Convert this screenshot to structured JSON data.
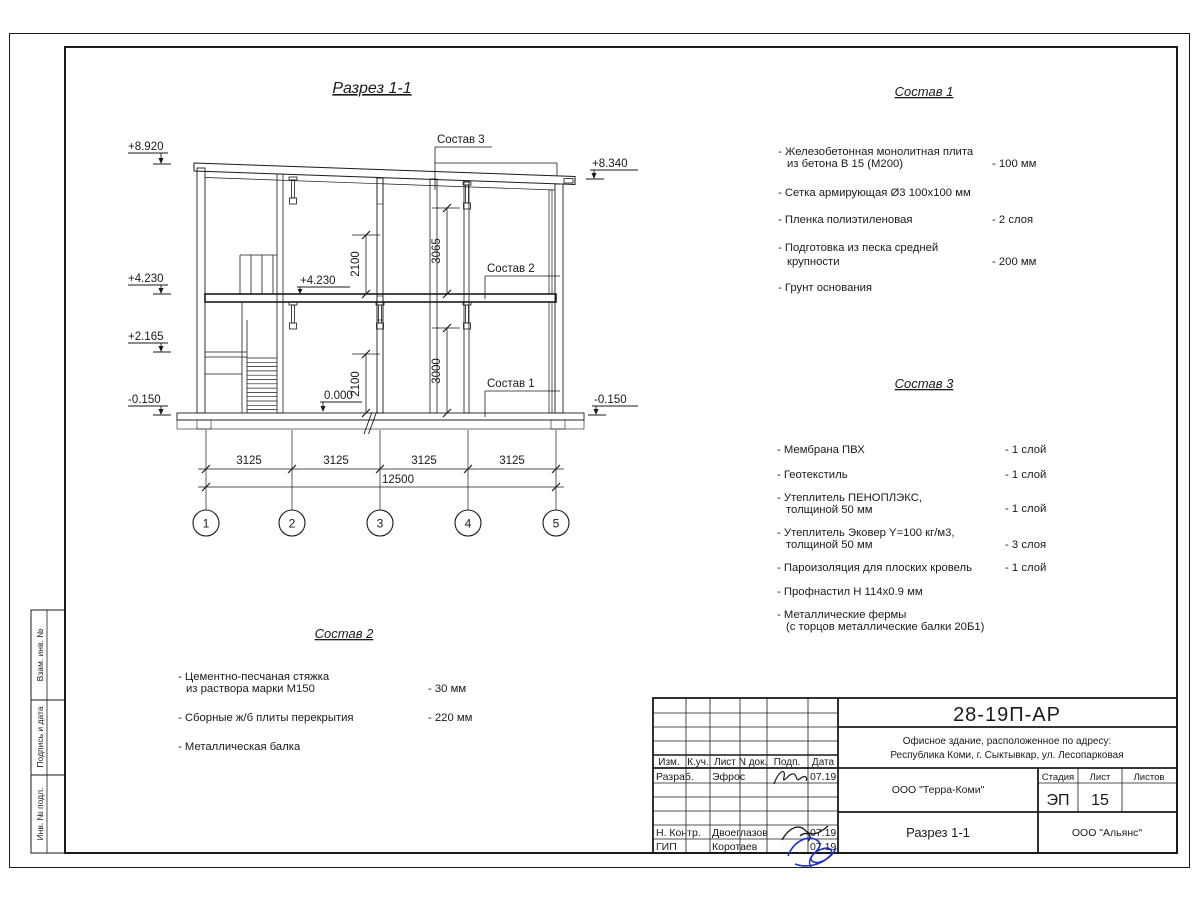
{
  "sheet": {
    "title": "Разрез 1-1",
    "stamps_side": {
      "top": "Взам. инв. №",
      "mid": "Подпись и дата",
      "bot": "Инв. № подл."
    }
  },
  "drawing": {
    "elev": {
      "l1": "+8.920",
      "l2": "+4.230",
      "l3": "+2.165",
      "l4": "-0.150",
      "r1": "+8.340",
      "r2": "-0.150",
      "mid": "+4.230",
      "zero": "0.000"
    },
    "vdims": {
      "d1": "2100",
      "d2": "3065",
      "d3": "2100",
      "d4": "3000"
    },
    "callouts": {
      "c1": "Состав 1",
      "c2": "Состав 2",
      "c3": "Состав 3"
    },
    "hdims": {
      "s1": "3125",
      "s2": "3125",
      "s3": "3125",
      "s4": "3125",
      "total": "12500"
    },
    "axes": {
      "a1": "1",
      "a2": "2",
      "a3": "3",
      "a4": "4",
      "a5": "5"
    }
  },
  "s1": {
    "title": "Состав 1",
    "i1a": "- Железобетонная  монолитная плита",
    "i1b": "из бетона В 15 (М200)",
    "i1v": "- 100 мм",
    "i2a": "- Сетка армирующая Ø3 100х100 мм",
    "i3a": "- Пленка полиэтиленовая",
    "i3v": "-  2 слоя",
    "i4a": "- Подготовка из песка средней",
    "i4b": "крупности",
    "i4v": "- 200 мм",
    "i5a": "- Грунт основания"
  },
  "s3": {
    "title": "Состав 3",
    "i1a": "- Мембрана ПВХ",
    "i1v": "- 1 слой",
    "i2a": "- Геотекстиль",
    "i2v": "- 1 слой",
    "i3a": "- Утеплитель ПЕНОПЛЭКС,",
    "i3b": "толщиной 50 мм",
    "i3v": "- 1 слой",
    "i4a": "- Утеплитель Эковер Y=100 кг/м3,",
    "i4b": "толщиной 50 мм",
    "i4v": "- 3 слоя",
    "i5a": "- Пароизоляция для плоских кровель",
    "i5v": "- 1 слой",
    "i6a": "- Профнастил Н 114х0.9 мм",
    "i7a": "- Металлические фермы",
    "i7b": "(с торцов металлические балки 20Б1)"
  },
  "s2": {
    "title": "Состав 2",
    "i1a": "- Цементно-песчаная стяжка",
    "i1b": "из раствора марки М150",
    "i1v": "- 30 мм",
    "i2a": "- Сборные ж/б плиты перекрытия",
    "i2v": "- 220 мм",
    "i3a": "- Металлическая балка"
  },
  "tb": {
    "code": "28-19П-АР",
    "addr1": "Офисное здание, расположенное по адресу:",
    "addr2": "Республика Коми, г. Сыктывкар, ул. Лесопарковая",
    "org1": "ООО \"Терра-Коми\"",
    "org2": "ООО \"Альянс\"",
    "sheet_title": "Разрез 1-1",
    "h_izm": "Изм.",
    "h_kuch": "К.уч.",
    "h_list": "Лист",
    "h_ndok": "N док.",
    "h_podp": "Подп.",
    "h_data": "Дата",
    "stage_l": "Стадия",
    "list_l": "Лист",
    "listov_l": "Листов",
    "stage_v": "ЭП",
    "list_v": "15",
    "r1_role": "Разраб.",
    "r1_name": "Эфрос",
    "r1_date": "07.19",
    "r2_role": "Н. Контр.",
    "r2_name": "Двоеглазов",
    "r2_date": "07.19",
    "r3_role": "ГИП",
    "r3_name": "Коротаев",
    "r3_date": "07.19"
  }
}
